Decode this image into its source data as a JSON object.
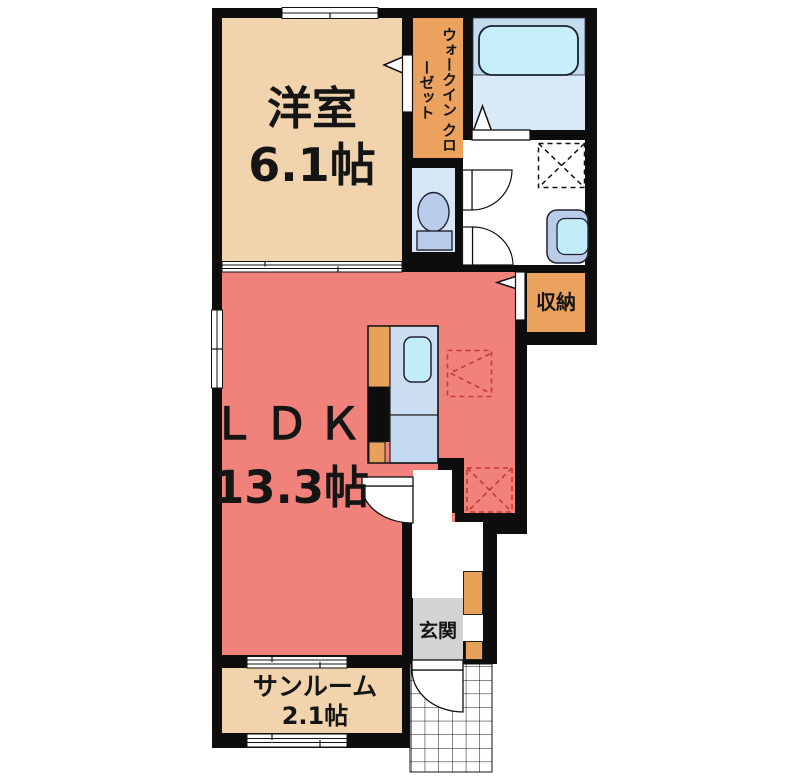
{
  "plan_title": "1LDK apartment floor plan",
  "colors": {
    "wall": "#0d0d0d",
    "room-beige": "#f1d3ad",
    "room-orange": "#eba25e",
    "counter-orange": "#e8a159",
    "ldk-red": "#f0827b",
    "bath-floor": "#d9e9f6",
    "tub-zone": "#c3dcee",
    "tub-fill": "#c6effa",
    "water-blue": "#ccdff2",
    "water-blue2": "#c4daf0",
    "sink-cyan": "#c2ecf8",
    "fixture-blue": "#b9cdeb",
    "toilet-room": "#d6e6f6",
    "genkan-gray": "#d3d3d5",
    "dash-red": "#c23b2e"
  },
  "rooms": {
    "western_room": {
      "label": "洋室",
      "size": "6.1帖"
    },
    "walk_in_closet": {
      "label_col_right": "ウォークイン",
      "label_col_left": "クローゼット"
    },
    "ldk": {
      "label": "ＬＤＫ",
      "size": "13.3帖"
    },
    "storage": {
      "label": "収納"
    },
    "entrance": {
      "label": "玄関"
    },
    "sunroom": {
      "label": "サンルーム",
      "size": "2.1帖"
    }
  },
  "fixtures": {
    "bathtub": "bathtub",
    "toilet": "toilet",
    "washbasin": "washbasin",
    "kitchen_sink": "kitchen-sink-counter",
    "washing_machine_space": "washing-machine-space (dashed)",
    "refrigerator_space": "refrigerator-space (dashed)",
    "equipment_space": "equipment-space (dashed)"
  }
}
